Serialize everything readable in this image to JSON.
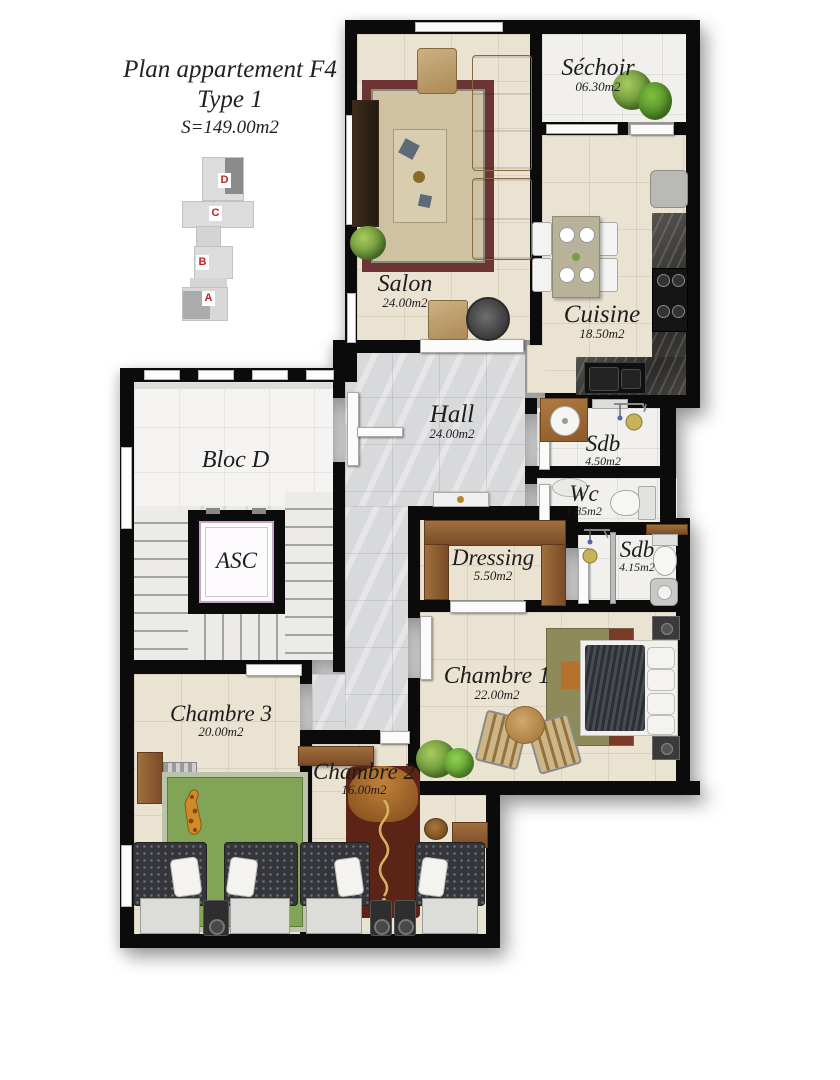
{
  "header": {
    "title": "Plan appartement F4",
    "subtitle": "Type 1",
    "surface": "S=149.00m2"
  },
  "key_plan": {
    "blocks": [
      "D",
      "C",
      "B",
      "A"
    ],
    "label_color": "#c22127"
  },
  "rooms": {
    "salon": {
      "name": "Salon",
      "area": "24.00m2"
    },
    "sechoir": {
      "name": "Séchoir",
      "area": "06.30m2"
    },
    "cuisine": {
      "name": "Cuisine",
      "area": "18.50m2"
    },
    "hall": {
      "name": "Hall",
      "area": "24.00m2"
    },
    "sdb1": {
      "name": "Sdb",
      "area": "4.50m2"
    },
    "wc": {
      "name": "Wc",
      "area": "1.85m2"
    },
    "dressing": {
      "name": "Dressing",
      "area": "5.50m2"
    },
    "sdb2": {
      "name": "Sdb",
      "area": "4.15m2"
    },
    "chambre1": {
      "name": "Chambre 1",
      "area": "22.00m2"
    },
    "chambre2": {
      "name": "Chambre 2",
      "area": "16.00m2"
    },
    "chambre3": {
      "name": "Chambre 3",
      "area": "20.00m2"
    },
    "bloc_d": {
      "name": "Bloc D"
    },
    "asc": {
      "name": "ASC"
    }
  },
  "colors": {
    "wall": "#0b0b0b",
    "floor_cream": "#eae3d1",
    "floor_hall": "#d8d9db",
    "floor_white": "#f1f0ed",
    "key_red": "#c22127",
    "wood": "#8a5a33",
    "rug_red": "#6d3434",
    "rug_green": "#82a457",
    "rug_maroon": "#5c2416",
    "counter_dark": "#3a3a3a"
  }
}
